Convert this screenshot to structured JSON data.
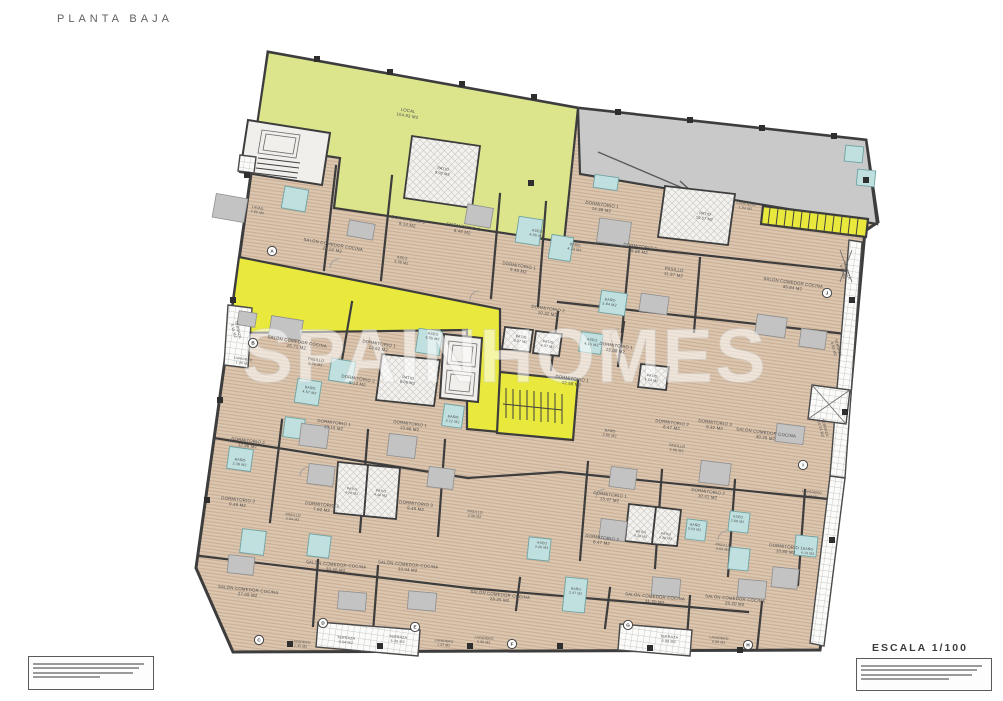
{
  "meta": {
    "title": "PLANTA BAJA",
    "scale": "ESCALA 1/100",
    "watermark": "SPAINHOMES"
  },
  "colors": {
    "local_green": "#dce48c",
    "corridor_yellow": "#e8e93c",
    "ramp_gray": "#c9c9c9",
    "floor_beige": "#dbc6b0",
    "floor_hatch": "#c8ab90",
    "bath_blue": "#bfe0df",
    "wall_dark": "#3d3d3d",
    "label_gray": "#4a4a4a"
  },
  "fineprint": {
    "left_line_widths": [
      96,
      91,
      86,
      58
    ],
    "right_line_widths": [
      96,
      92,
      88,
      70
    ]
  },
  "markers": [
    {
      "label": "A",
      "x": 272,
      "y": 251
    },
    {
      "label": "B",
      "x": 253,
      "y": 343
    },
    {
      "label": "C",
      "x": 259,
      "y": 640
    },
    {
      "label": "D",
      "x": 323,
      "y": 623
    },
    {
      "label": "E",
      "x": 415,
      "y": 627
    },
    {
      "label": "F",
      "x": 512,
      "y": 644
    },
    {
      "label": "G",
      "x": 628,
      "y": 625
    },
    {
      "label": "H",
      "x": 748,
      "y": 645
    },
    {
      "label": "I",
      "x": 803,
      "y": 465
    },
    {
      "label": "J",
      "x": 827,
      "y": 293
    }
  ],
  "rooms": [
    {
      "name": "LOCAL",
      "area": "104.93 M2",
      "x": 408,
      "y": 112,
      "r": 10
    },
    {
      "name": "PATIO",
      "area": "9.00 M2",
      "x": 443,
      "y": 170,
      "r": 10,
      "fs": 3.8
    },
    {
      "name": "LAVAD.",
      "area": "3.05 M2",
      "x": 258,
      "y": 209,
      "r": 10,
      "fs": 3.4
    },
    {
      "name": "DORMITORIO 3",
      "area": "9.14 M2",
      "x": 408,
      "y": 221,
      "r": 10
    },
    {
      "name": "DORMITORIO 2",
      "area": "8.46 M2",
      "x": 463,
      "y": 228,
      "r": 10
    },
    {
      "name": "ASEO",
      "area": "4.05 M2",
      "x": 537,
      "y": 232,
      "r": 9,
      "fs": 3.6
    },
    {
      "name": "DORMITORIO 1",
      "area": "9.48 M2",
      "x": 519,
      "y": 267,
      "r": 9
    },
    {
      "name": "BAÑO",
      "area": "4.34 M2",
      "x": 575,
      "y": 246,
      "r": 9,
      "fs": 3.6
    },
    {
      "name": "SALÓN COMEDOR COCINA",
      "area": "21.52 M2",
      "x": 333,
      "y": 246,
      "r": 10
    },
    {
      "name": "ASEO",
      "area": "3.38 M2",
      "x": 402,
      "y": 259,
      "r": 10,
      "fs": 3.6
    },
    {
      "name": "DORMITORIO 1",
      "area": "14.38 M2",
      "x": 602,
      "y": 206,
      "r": 8
    },
    {
      "name": "LAVADERO",
      "area": "1.94 M2",
      "x": 746,
      "y": 205,
      "r": 8,
      "fs": 3.4
    },
    {
      "name": "PATIO",
      "area": "10.57 M2",
      "x": 705,
      "y": 215,
      "r": 8,
      "fs": 3.8
    },
    {
      "name": "DORMITORIO 2",
      "area": "9.85 M2",
      "x": 640,
      "y": 248,
      "r": 8
    },
    {
      "name": "PASILLO",
      "area": "11.57 M2",
      "x": 674,
      "y": 271,
      "r": 8
    },
    {
      "name": "SALÓN COMEDOR COCINA",
      "area": "33.84 M2",
      "x": 793,
      "y": 284,
      "r": 8
    },
    {
      "name": "TERRAZA",
      "area": "6.06 M2",
      "x": 846,
      "y": 271,
      "r": 74,
      "fs": 3.6
    },
    {
      "name": "BAÑO",
      "area": "5.94 M2",
      "x": 610,
      "y": 301,
      "r": 8,
      "fs": 3.6
    },
    {
      "name": "DORMITORIO 2",
      "area": "10.32 M2",
      "x": 548,
      "y": 310,
      "r": 8
    },
    {
      "name": "TERRAZA",
      "area": "5.15 M2",
      "x": 237,
      "y": 330,
      "r": 76,
      "fs": 3.6
    },
    {
      "name": "SALÓN COMEDOR COCINA",
      "area": "25.71 M2",
      "x": 297,
      "y": 343,
      "r": 9
    },
    {
      "name": "DORMITORIO 1",
      "area": "13.62 M2",
      "x": 379,
      "y": 345,
      "r": 9
    },
    {
      "name": "ASEO",
      "area": "3.35 M2",
      "x": 433,
      "y": 335,
      "r": 9,
      "fs": 3.6
    },
    {
      "name": "LAVADERO",
      "area": "1.06 M2",
      "x": 243,
      "y": 360,
      "r": 9,
      "fs": 3.3
    },
    {
      "name": "PASILLO",
      "area": "5.75 M2",
      "x": 316,
      "y": 361,
      "r": 9,
      "fs": 3.6
    },
    {
      "name": "BAÑO",
      "area": "4.57 M2",
      "x": 310,
      "y": 389,
      "r": 9,
      "fs": 3.6
    },
    {
      "name": "DORMITORIO 2",
      "area": "8.13 M2",
      "x": 358,
      "y": 380,
      "r": 9
    },
    {
      "name": "PATIO",
      "area": "9.06 M2",
      "x": 408,
      "y": 379,
      "r": 9,
      "fs": 3.8
    },
    {
      "name": "PATIO",
      "area": "6.37 M2",
      "x": 521,
      "y": 338,
      "r": 8,
      "fs": 3.5
    },
    {
      "name": "PATIO",
      "area": "4.37 M2",
      "x": 548,
      "y": 343,
      "r": 8,
      "fs": 3.5
    },
    {
      "name": "ASEO",
      "area": "4.15 M2",
      "x": 592,
      "y": 341,
      "r": 8,
      "fs": 3.6
    },
    {
      "name": "DORMITORIO 1",
      "area": "12.58 M2",
      "x": 572,
      "y": 380,
      "r": 8
    },
    {
      "name": "PATIO",
      "area": "5.54 M2",
      "x": 652,
      "y": 377,
      "r": 8,
      "fs": 3.5
    },
    {
      "name": "DORMITORIO 1",
      "area": "13.08 M2",
      "x": 616,
      "y": 347,
      "r": 8
    },
    {
      "name": "SALÓN COMEDOR COCINA",
      "area": "30.25 M2",
      "x": 766,
      "y": 434,
      "r": 7
    },
    {
      "name": "TERRAZA",
      "area": "10.24 M2",
      "x": 824,
      "y": 428,
      "r": 74,
      "fs": 3.6
    },
    {
      "name": "DORMITORIO 2",
      "area": "8.47 M2",
      "x": 672,
      "y": 424,
      "r": 7
    },
    {
      "name": "DORMITORIO 3",
      "area": "9.32 M2",
      "x": 715,
      "y": 424,
      "r": 7
    },
    {
      "name": "PASILLO",
      "area": "5.06 M2",
      "x": 677,
      "y": 447,
      "r": 7,
      "fs": 3.6
    },
    {
      "name": "BAÑO",
      "area": "3.60 M2",
      "x": 610,
      "y": 432,
      "r": 7,
      "fs": 3.6
    },
    {
      "name": "TERRAZA",
      "area": "6.95 M2",
      "x": 837,
      "y": 348,
      "r": 74,
      "fs": 3.6
    },
    {
      "name": "DORMITORIO 1",
      "area": "13.15 M2",
      "x": 334,
      "y": 424,
      "r": 7
    },
    {
      "name": "DORMITORIO 1",
      "area": "13.66 M2",
      "x": 410,
      "y": 425,
      "r": 7
    },
    {
      "name": "DORMITORIO 2",
      "area": "12.66 M2",
      "x": 248,
      "y": 442,
      "r": 7
    },
    {
      "name": "BAÑO",
      "area": "3.36 M2",
      "x": 240,
      "y": 461,
      "r": 7,
      "fs": 3.6
    },
    {
      "name": "DORMITORIO 3",
      "area": "9.46 M2",
      "x": 238,
      "y": 501,
      "r": 6
    },
    {
      "name": "DORMITORIO 2",
      "area": "7.92 M2",
      "x": 322,
      "y": 506,
      "r": 6
    },
    {
      "name": "DORMITORIO 3",
      "area": "9.45 M2",
      "x": 416,
      "y": 505,
      "r": 6
    },
    {
      "name": "PATIO",
      "area": "4.28 M2",
      "x": 352,
      "y": 490,
      "r": 7,
      "fs": 3.3
    },
    {
      "name": "PATIO",
      "area": "4.48 M2",
      "x": 381,
      "y": 492,
      "r": 7,
      "fs": 3.3
    },
    {
      "name": "BAÑO",
      "area": "3.12 M2",
      "x": 453,
      "y": 418,
      "r": 7,
      "fs": 3.6
    },
    {
      "name": "PASILLO",
      "area": "2.94 M2",
      "x": 293,
      "y": 516,
      "r": 6,
      "fs": 3.4
    },
    {
      "name": "PASILLO",
      "area": "2.96 M2",
      "x": 475,
      "y": 513,
      "r": 6,
      "fs": 3.4
    },
    {
      "name": "DORMITORIO 1",
      "area": "13.47 M2",
      "x": 610,
      "y": 496,
      "r": 7
    },
    {
      "name": "DORMITORIO 2",
      "area": "10.41 M2",
      "x": 708,
      "y": 493,
      "r": 7
    },
    {
      "name": "PATIO",
      "area": "4.29 M2",
      "x": 641,
      "y": 533,
      "r": 7,
      "fs": 3.3
    },
    {
      "name": "PATIO",
      "area": "4.38 M2",
      "x": 666,
      "y": 535,
      "r": 7,
      "fs": 3.3
    },
    {
      "name": "BAÑO",
      "area": "3.03 M2",
      "x": 695,
      "y": 526,
      "r": 7,
      "fs": 3.4
    },
    {
      "name": "ASEO",
      "area": "2.66 M2",
      "x": 738,
      "y": 518,
      "r": 7,
      "fs": 3.4
    },
    {
      "name": "DORMITORIO 3",
      "area": "8.47 M2",
      "x": 602,
      "y": 539,
      "r": 7
    },
    {
      "name": "LAVADERO",
      "area": "3.47 M2",
      "x": 812,
      "y": 493,
      "r": 7,
      "fs": 3.4
    },
    {
      "name": "DORMITORIO 1",
      "area": "10.89 M2",
      "x": 786,
      "y": 548,
      "r": 6
    },
    {
      "name": "PASILLO",
      "area": "3.63 M2",
      "x": 723,
      "y": 546,
      "r": 6,
      "fs": 3.4
    },
    {
      "name": "SALÓN-COMEDOR-COCINA",
      "area": "27.09 M2",
      "x": 248,
      "y": 591,
      "r": 6
    },
    {
      "name": "SALÓN-COMEDOR-COCINA",
      "area": "33.26 M2",
      "x": 336,
      "y": 566,
      "r": 5
    },
    {
      "name": "SALÓN-COMEDOR-COCINA",
      "area": "33.04 M2",
      "x": 408,
      "y": 566,
      "r": 5
    },
    {
      "name": "SALÓN COMEDOR COCINA",
      "area": "28.25 M2",
      "x": 500,
      "y": 596,
      "r": 6
    },
    {
      "name": "SALÓN COMEDOR COCINA",
      "area": "31.20 M2",
      "x": 655,
      "y": 598,
      "r": 5
    },
    {
      "name": "SALÓN COMEDOR COCINA",
      "area": "29.20 M2",
      "x": 735,
      "y": 600,
      "r": 5
    },
    {
      "name": "TERRAZA",
      "area": "5.54 M2",
      "x": 346,
      "y": 639,
      "r": 5,
      "fs": 3.6
    },
    {
      "name": "TERRAZA",
      "area": "5.35 M2",
      "x": 398,
      "y": 638,
      "r": 5,
      "fs": 3.6
    },
    {
      "name": "TERRAZA",
      "area": "5.93 M2",
      "x": 669,
      "y": 638,
      "r": 5,
      "fs": 3.6
    },
    {
      "name": "LAVADERO",
      "area": "1.35 M2",
      "x": 301,
      "y": 643,
      "r": 5,
      "fs": 3.3
    },
    {
      "name": "LAVADERO",
      "area": "1.37 M2",
      "x": 444,
      "y": 642,
      "r": 5,
      "fs": 3.3
    },
    {
      "name": "LAVADERO",
      "area": "5.90 M2",
      "x": 484,
      "y": 639,
      "r": 5,
      "fs": 3.3
    },
    {
      "name": "LAVADERO",
      "area": "0.89 M2",
      "x": 719,
      "y": 639,
      "r": 5,
      "fs": 3.3
    },
    {
      "name": "ASEO",
      "area": "3.26 M2",
      "x": 542,
      "y": 544,
      "r": 6,
      "fs": 3.4
    },
    {
      "name": "BAÑO",
      "area": "2.47 M2",
      "x": 576,
      "y": 590,
      "r": 6,
      "fs": 3.3
    },
    {
      "name": "BAÑO",
      "area": "4.13 M2",
      "x": 808,
      "y": 550,
      "r": 6,
      "fs": 3.4
    }
  ]
}
